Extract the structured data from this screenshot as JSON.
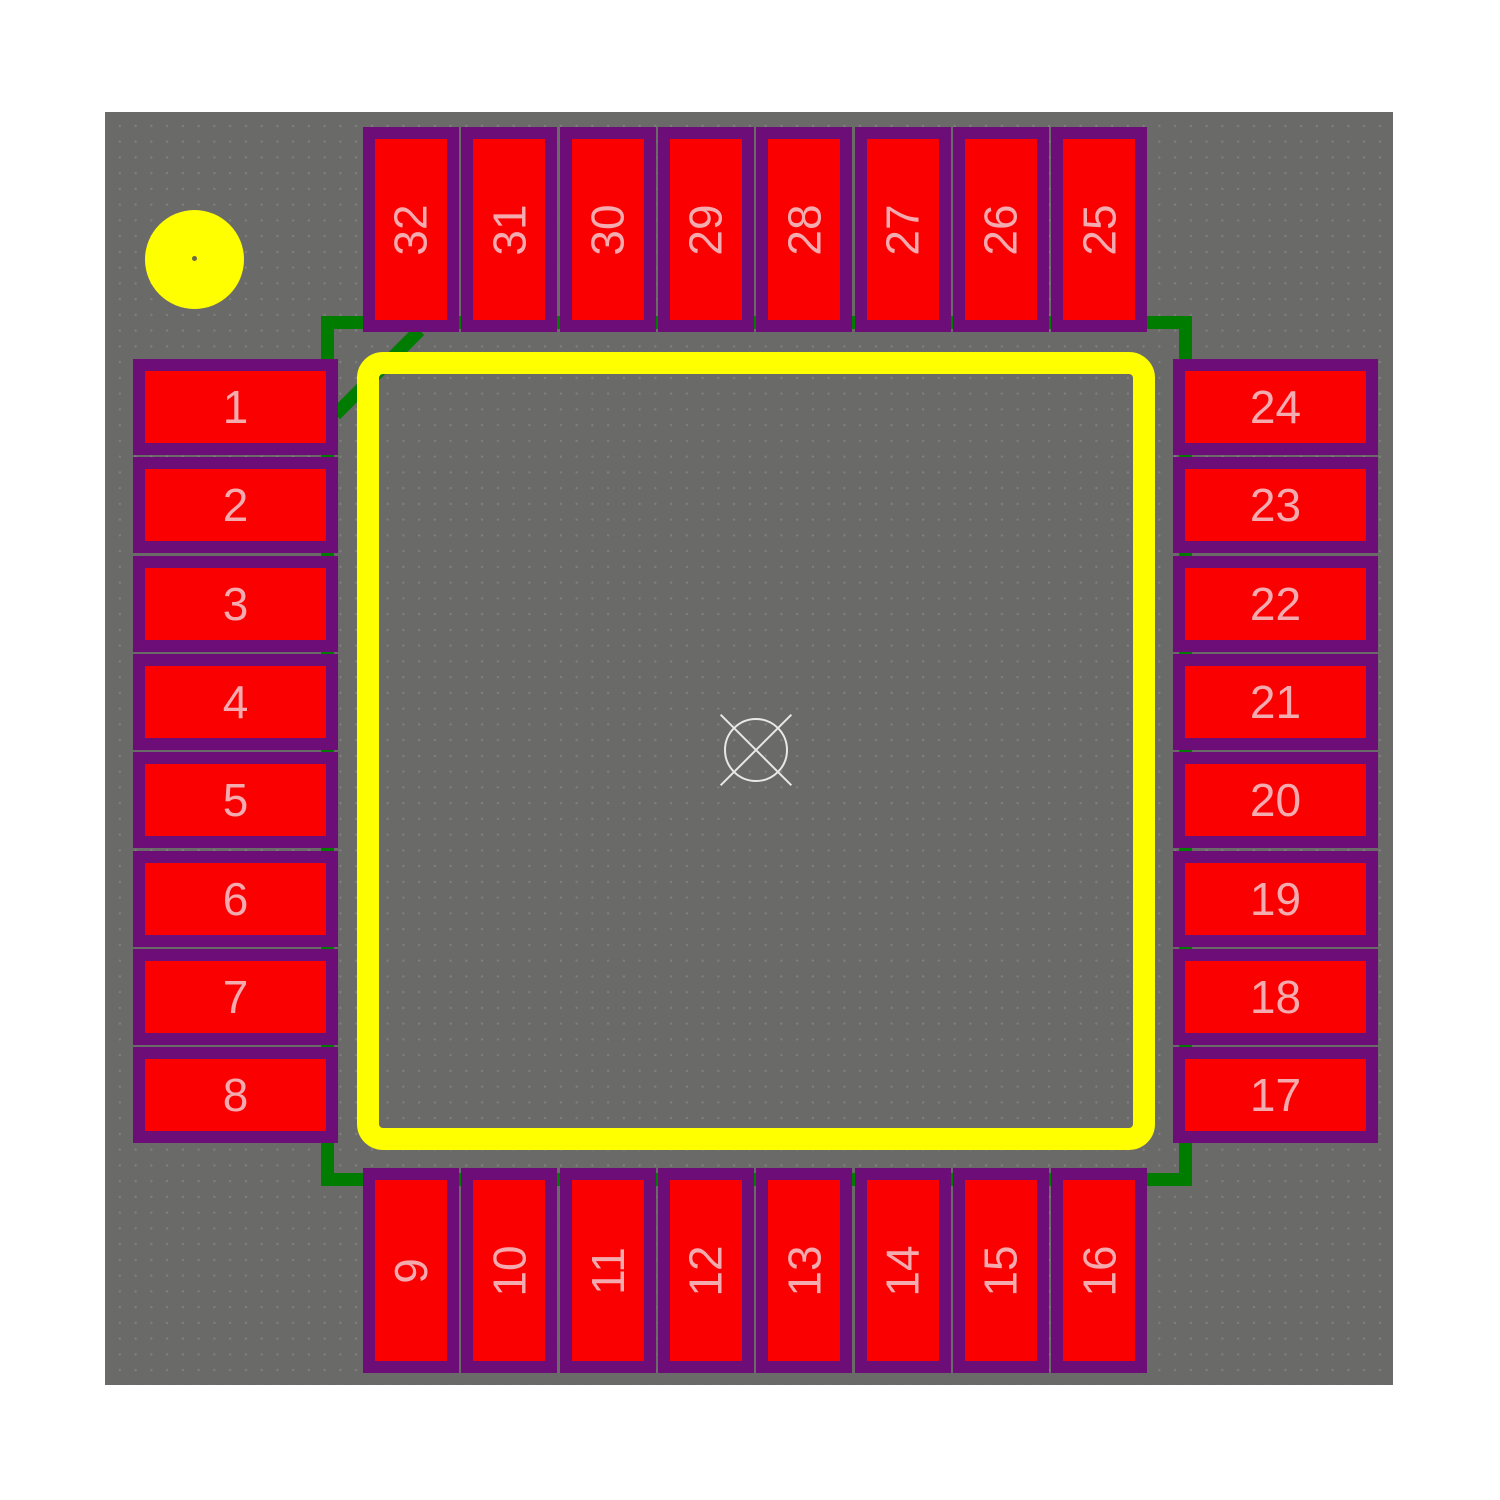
{
  "pads": {
    "left": [
      "1",
      "2",
      "3",
      "4",
      "5",
      "6",
      "7",
      "8"
    ],
    "top": [
      "32",
      "31",
      "30",
      "29",
      "28",
      "27",
      "26",
      "25"
    ],
    "right": [
      "24",
      "23",
      "22",
      "21",
      "20",
      "19",
      "18",
      "17"
    ],
    "bottom": [
      "9",
      "10",
      "11",
      "12",
      "13",
      "14",
      "15",
      "16"
    ]
  },
  "icons": {
    "origin_marker": "circle-with-x-crosshair",
    "pin1_indicator": "filled-circle"
  },
  "colors": {
    "page_bg": "#ffffff",
    "canvas_bg": "#6a6a68",
    "pad_fill": "#fb0000",
    "pad_outline": "#6d0e78",
    "pad_number_text": "#f3abb0",
    "silkscreen": "#ffff00",
    "courtyard": "#007d00",
    "origin_marker": "#e8e8e8"
  }
}
